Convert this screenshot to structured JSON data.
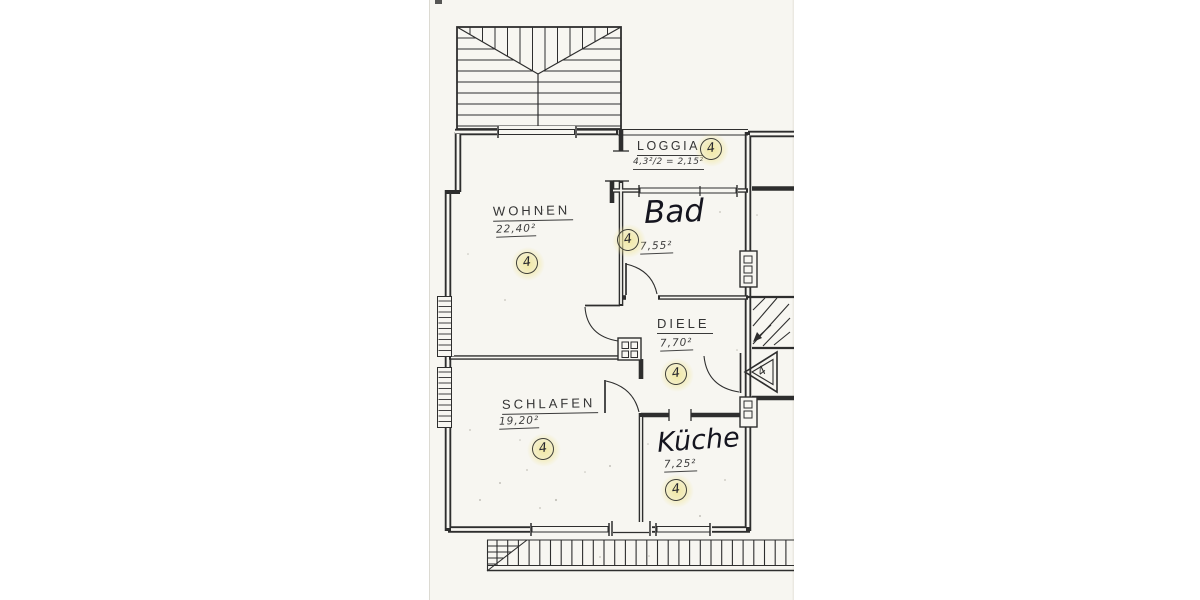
{
  "page": {
    "background": "#ffffff",
    "paper_color": "#f7f6f1",
    "ink_color": "#2e2e2e",
    "highlight_color": "#f0e7a0"
  },
  "rooms": [
    {
      "name": "WOHNEN",
      "area": "22,40²",
      "badge": "4",
      "style": "drafted"
    },
    {
      "name": "LOGGIA",
      "area": "4,3²/2 = 2,15²",
      "badge": "4",
      "style": "drafted"
    },
    {
      "name": "Bad",
      "area": "7,55²",
      "badge": "4",
      "style": "handwritten"
    },
    {
      "name": "DIELE",
      "area": "7,70²",
      "badge": "4",
      "style": "drafted"
    },
    {
      "name": "SCHLAFEN",
      "area": "19,20²",
      "badge": "4",
      "style": "drafted"
    },
    {
      "name": "Küche",
      "area": "7,25²",
      "badge": "4",
      "style": "handwritten"
    }
  ],
  "markers": {
    "entry_triangle_label": "4"
  }
}
